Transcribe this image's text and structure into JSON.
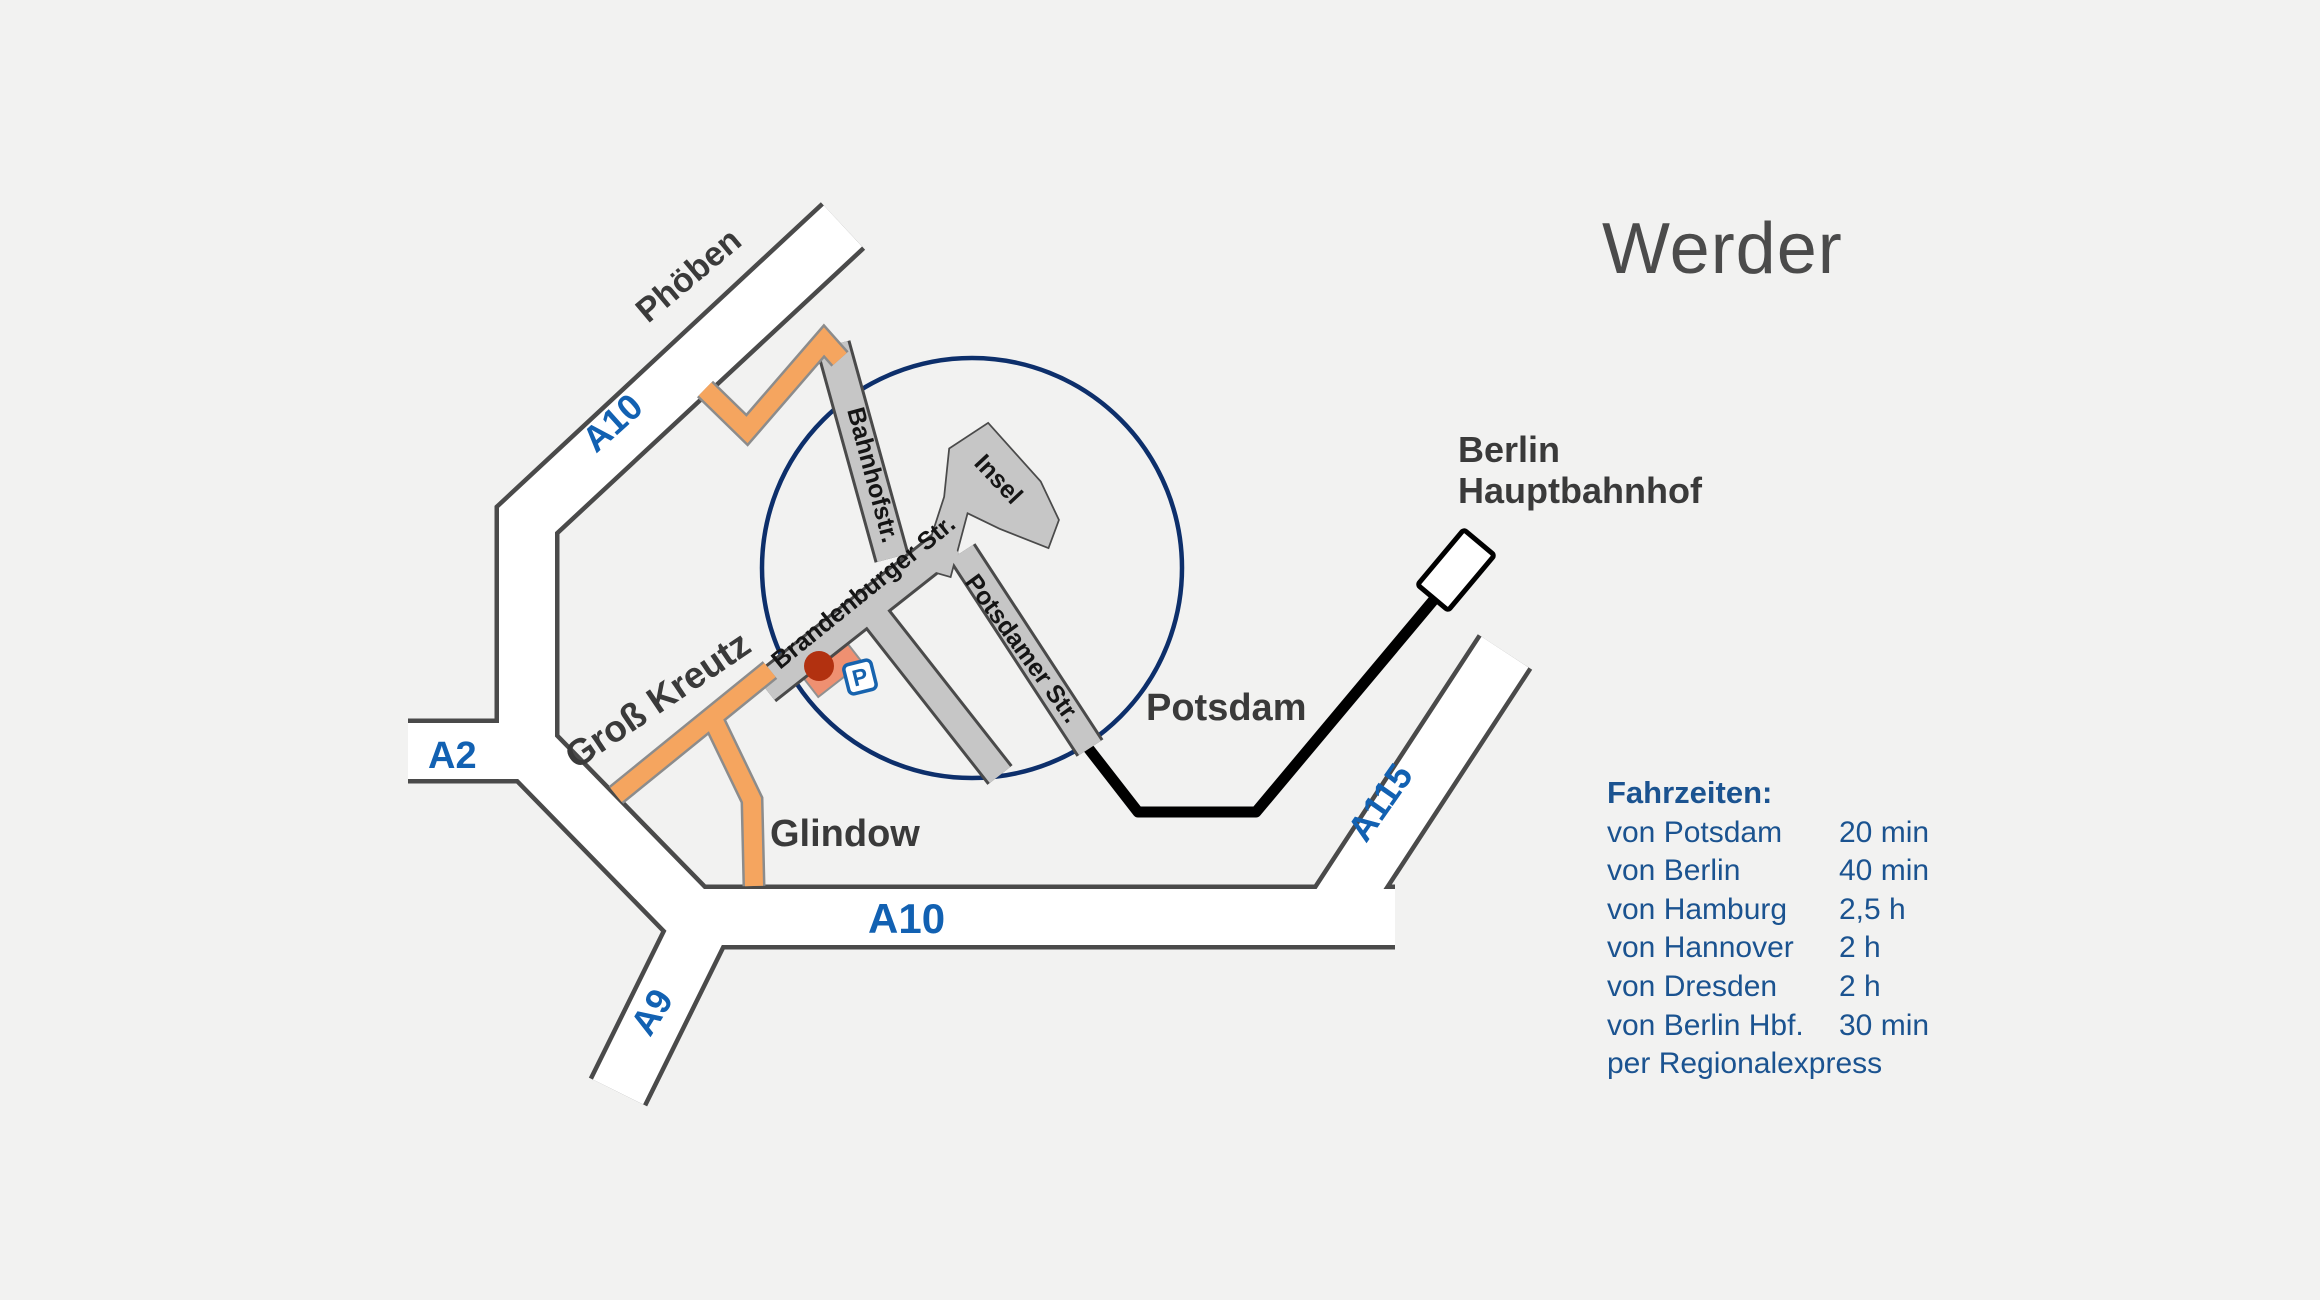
{
  "title": "Werder",
  "map": {
    "highway_labels": {
      "a10_nw": "A10",
      "a2": "A2",
      "a9": "A9",
      "a10_south": "A10",
      "a115": "A115"
    },
    "place_labels": {
      "phoeben": "Phöben",
      "gross_kreutz": "Groß Kreutz",
      "glindow": "Glindow",
      "potsdam": "Potsdam",
      "berlin_hbf_line1": "Berlin",
      "berlin_hbf_line2": "Hauptbahnhof"
    },
    "street_labels": {
      "bahnhofstr": "Bahnhofstr.",
      "brandenburger": "Brandenburger Str.",
      "potsdamer": "Potsdamer Str.",
      "insel": "Insel"
    },
    "parking_label": "P",
    "colors": {
      "background": "#f2f2f1",
      "road_casing": "#4a4a4a",
      "road_fill": "#ffffff",
      "street_fill": "#c6c6c6",
      "orange_road": "#f5a55f",
      "orange_casing": "#8c8c8c",
      "focus_circle": "#0d2f6b",
      "railway": "#000000",
      "highway_label_blue": "#1261b2",
      "travel_text_blue": "#1b5390",
      "marker_red": "#b23110",
      "building_salmon": "#ef9071",
      "parking_blue": "#1763ae",
      "title_gray": "#4b4b4b"
    }
  },
  "travel_times": {
    "heading": "Fahrzeiten:",
    "rows": [
      {
        "label": "von Potsdam",
        "time": "20 min"
      },
      {
        "label": "von Berlin",
        "time": "40 min"
      },
      {
        "label": "von Hamburg",
        "time": "2,5  h"
      },
      {
        "label": "von Hannover",
        "time": "2 h"
      },
      {
        "label": "von Dresden",
        "time": "2 h"
      },
      {
        "label": "von Berlin Hbf.",
        "time": "30 min"
      }
    ],
    "note": "per Regionalexpress"
  }
}
